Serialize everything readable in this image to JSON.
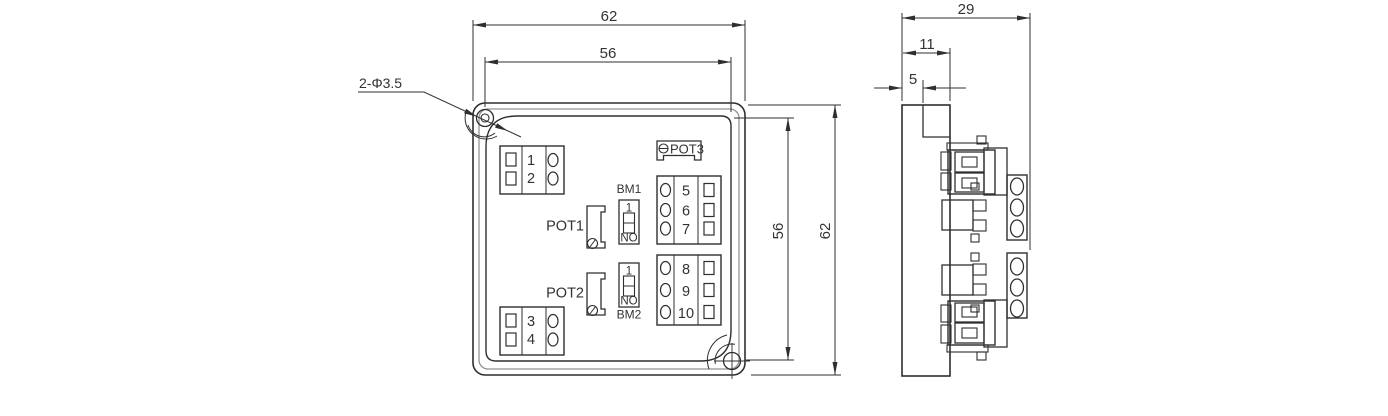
{
  "front_view": {
    "hole_callout": "2-Φ3.5",
    "dims": {
      "width_outer": "62",
      "width_inner": "56",
      "height_inner": "56",
      "height_outer": "62"
    },
    "blocks": {
      "left_top": [
        "1",
        "2"
      ],
      "left_bottom": [
        "3",
        "4"
      ],
      "right_top": [
        "5",
        "6",
        "7"
      ],
      "right_bottom": [
        "8",
        "9",
        "10"
      ]
    },
    "pots": {
      "pot1": "POT1",
      "pot2": "POT2",
      "pot3": "POT3"
    },
    "switches": {
      "bm1": {
        "label": "BM1",
        "pos_top": "1",
        "pos_bottom": "NO"
      },
      "bm2": {
        "label": "BM2",
        "pos_top": "1",
        "pos_bottom": "NO"
      }
    }
  },
  "side_view": {
    "dims": {
      "depth_total": "29",
      "depth_body": "11",
      "depth_flange": "5"
    }
  },
  "colors": {
    "line": "#2f2f2f",
    "line_light": "#949494",
    "text": "#333333",
    "background": "#ffffff"
  }
}
